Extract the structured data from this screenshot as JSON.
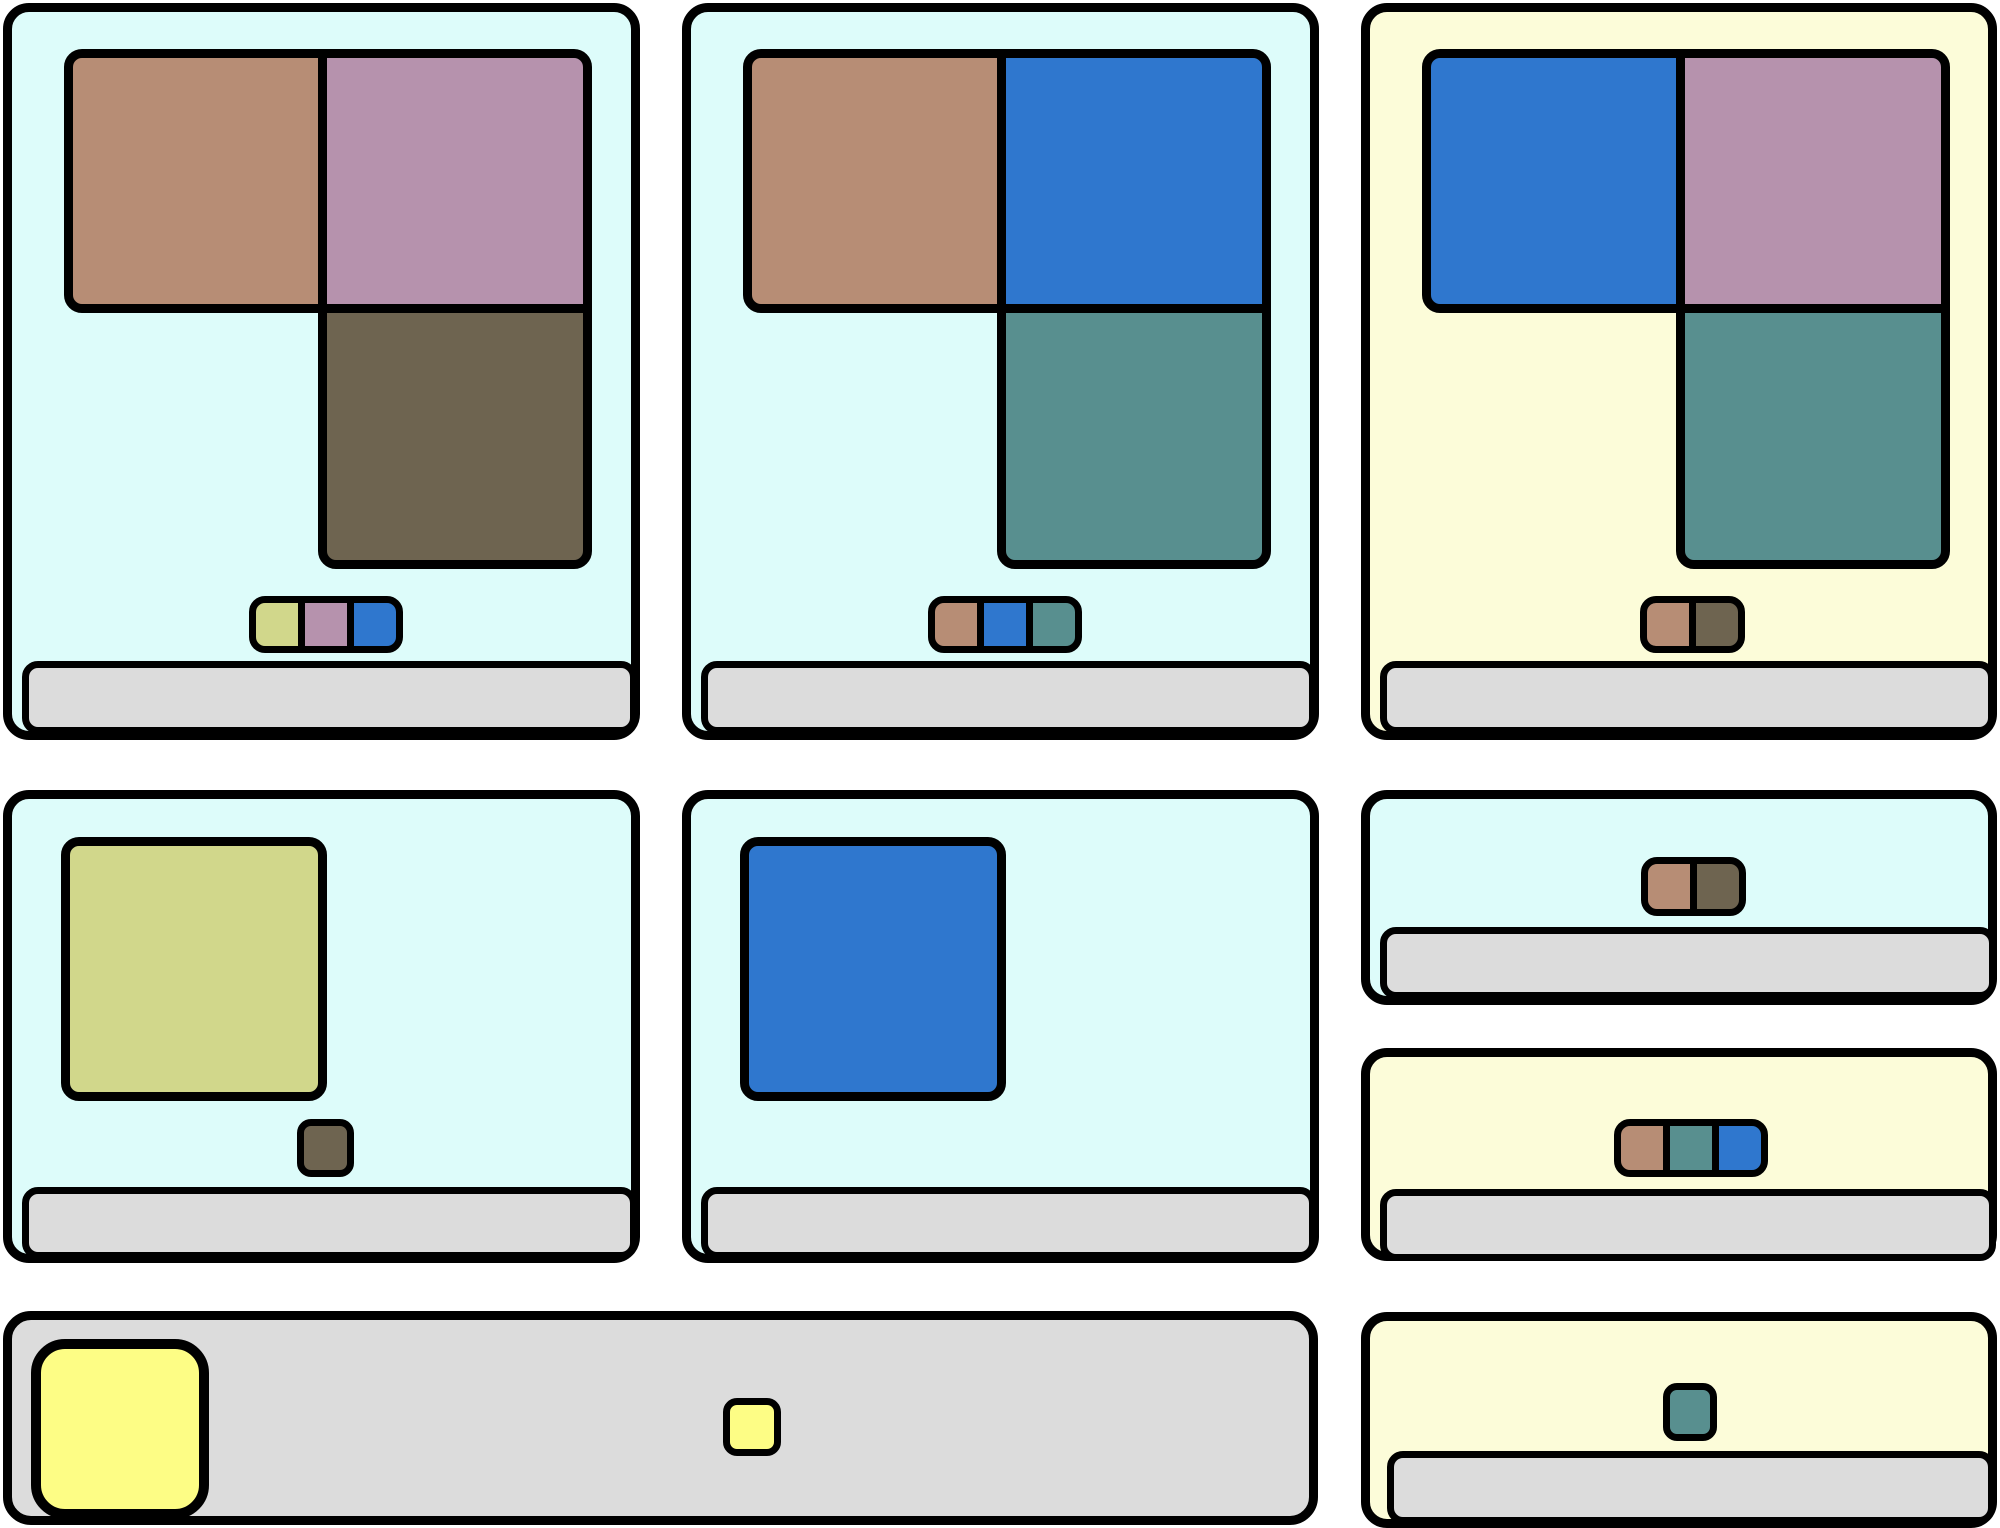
{
  "canvas": {
    "width": 2000,
    "height": 1528,
    "background": "#ffffff"
  },
  "palette": {
    "cyan_panel": "#ddfcfa",
    "yellow_panel": "#fcfcd9",
    "bar_gray": "#dcdcdc",
    "outline": "#000000",
    "brown": "#b78d75",
    "mauve": "#b692ad",
    "olive": "#6e6450",
    "blue": "#2f77ce",
    "teal": "#588f8f",
    "yellow_green": "#d1d78b",
    "bright_yellow": "#fdfd85"
  },
  "panels": [
    {
      "id": "card-row1-col1",
      "x": 3,
      "y": 3,
      "w": 637,
      "h": 737,
      "bg": "cyan_panel",
      "radius": 26,
      "blocks": [
        {
          "name": "block-brown",
          "color": "brown",
          "x": 52,
          "y": 37,
          "w": 263,
          "h": 264,
          "corners": "left"
        },
        {
          "name": "block-mauve",
          "color": "mauve",
          "x": 306,
          "y": 37,
          "w": 274,
          "h": 264,
          "corners": "top-right"
        },
        {
          "name": "block-olive",
          "color": "olive",
          "x": 306,
          "y": 292,
          "w": 274,
          "h": 265,
          "corners": "bottom"
        }
      ],
      "chip_groups": [
        {
          "x": 237,
          "y": 584,
          "h": 57,
          "chip_w": 56,
          "colors": [
            "yellow_green",
            "mauve",
            "blue"
          ]
        }
      ],
      "bar": {
        "x": 10,
        "y": 649,
        "w": 615,
        "h": 73
      }
    },
    {
      "id": "card-row1-col2",
      "x": 682,
      "y": 3,
      "w": 637,
      "h": 737,
      "bg": "cyan_panel",
      "radius": 26,
      "blocks": [
        {
          "name": "block-brown",
          "color": "brown",
          "x": 52,
          "y": 37,
          "w": 263,
          "h": 264,
          "corners": "left"
        },
        {
          "name": "block-blue",
          "color": "blue",
          "x": 306,
          "y": 37,
          "w": 274,
          "h": 264,
          "corners": "top-right"
        },
        {
          "name": "block-teal",
          "color": "teal",
          "x": 306,
          "y": 292,
          "w": 274,
          "h": 265,
          "corners": "bottom"
        }
      ],
      "chip_groups": [
        {
          "x": 237,
          "y": 584,
          "h": 57,
          "chip_w": 56,
          "colors": [
            "brown",
            "blue",
            "teal"
          ]
        }
      ],
      "bar": {
        "x": 10,
        "y": 649,
        "w": 615,
        "h": 73
      }
    },
    {
      "id": "card-row1-col3",
      "x": 1361,
      "y": 3,
      "w": 636,
      "h": 737,
      "bg": "yellow_panel",
      "radius": 26,
      "blocks": [
        {
          "name": "block-blue",
          "color": "blue",
          "x": 52,
          "y": 37,
          "w": 263,
          "h": 264,
          "corners": "left"
        },
        {
          "name": "block-mauve",
          "color": "mauve",
          "x": 306,
          "y": 37,
          "w": 274,
          "h": 264,
          "corners": "top-right"
        },
        {
          "name": "block-teal",
          "color": "teal",
          "x": 306,
          "y": 292,
          "w": 274,
          "h": 265,
          "corners": "bottom"
        }
      ],
      "chip_groups": [
        {
          "x": 270,
          "y": 584,
          "h": 57,
          "chip_w": 56,
          "colors": [
            "brown",
            "olive"
          ]
        }
      ],
      "bar": {
        "x": 10,
        "y": 649,
        "w": 615,
        "h": 73
      }
    },
    {
      "id": "card-row2-col1",
      "x": 3,
      "y": 790,
      "w": 637,
      "h": 473,
      "bg": "cyan_panel",
      "radius": 26,
      "blocks": [
        {
          "name": "block-yellow-green",
          "color": "yellow_green",
          "x": 49,
          "y": 38,
          "w": 266,
          "h": 264,
          "corners": "all"
        },
        {
          "name": "chip-olive",
          "color": "olive",
          "x": 285,
          "y": 320,
          "w": 57,
          "h": 58,
          "corners": "chip"
        }
      ],
      "chip_groups": [],
      "bar": {
        "x": 10,
        "y": 388,
        "w": 615,
        "h": 72
      }
    },
    {
      "id": "card-row2-col2",
      "x": 682,
      "y": 790,
      "w": 637,
      "h": 473,
      "bg": "cyan_panel",
      "radius": 26,
      "blocks": [
        {
          "name": "block-blue",
          "color": "blue",
          "x": 49,
          "y": 38,
          "w": 266,
          "h": 264,
          "corners": "all"
        }
      ],
      "chip_groups": [],
      "bar": {
        "x": 10,
        "y": 388,
        "w": 615,
        "h": 72
      }
    },
    {
      "id": "card-row2-col3-top",
      "x": 1361,
      "y": 790,
      "w": 636,
      "h": 215,
      "bg": "cyan_panel",
      "radius": 26,
      "blocks": [],
      "chip_groups": [
        {
          "x": 271,
          "y": 58,
          "h": 59,
          "chip_w": 56,
          "colors": [
            "brown",
            "olive"
          ]
        }
      ],
      "bar": {
        "x": 10,
        "y": 128,
        "w": 616,
        "h": 72
      }
    },
    {
      "id": "card-row2-col3-bottom",
      "x": 1361,
      "y": 1048,
      "w": 636,
      "h": 213,
      "bg": "yellow_panel",
      "radius": 26,
      "blocks": [],
      "chip_groups": [
        {
          "x": 244,
          "y": 62,
          "h": 58,
          "chip_w": 56,
          "colors": [
            "brown",
            "teal",
            "blue"
          ]
        }
      ],
      "bar": {
        "x": 10,
        "y": 132,
        "w": 616,
        "h": 72
      }
    },
    {
      "id": "tray-bottom",
      "x": 3,
      "y": 1311,
      "w": 1315,
      "h": 214,
      "bg": "bar_gray",
      "radius": 28,
      "blocks": [
        {
          "name": "block-bright-yellow",
          "color": "bright_yellow",
          "x": 19,
          "y": 19,
          "w": 178,
          "h": 180,
          "corners": "big"
        },
        {
          "name": "chip-bright-yellow",
          "color": "bright_yellow",
          "x": 711,
          "y": 78,
          "w": 58,
          "h": 58,
          "corners": "chip"
        }
      ],
      "chip_groups": []
    },
    {
      "id": "card-row3-col3",
      "x": 1361,
      "y": 1312,
      "w": 636,
      "h": 216,
      "bg": "yellow_panel",
      "radius": 26,
      "blocks": [],
      "chip_groups": [
        {
          "x": 293,
          "y": 62,
          "h": 58,
          "chip_w": 54,
          "colors": [
            "teal"
          ]
        }
      ],
      "bar": {
        "x": 17,
        "y": 130,
        "w": 608,
        "h": 73
      }
    }
  ]
}
